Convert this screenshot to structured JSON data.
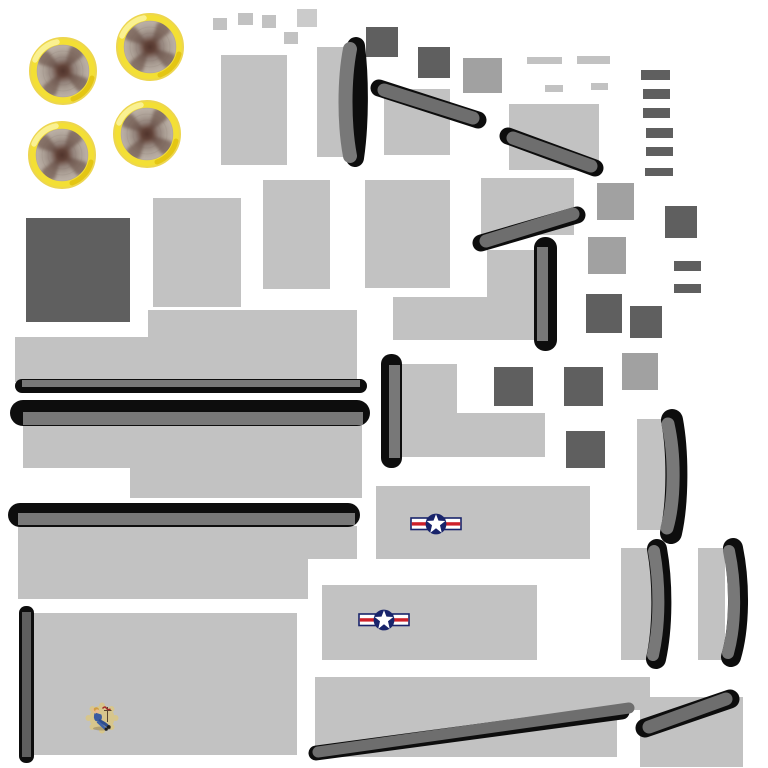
{
  "palette": {
    "bg": "#FFFFFF",
    "light": "#C2C2C2",
    "lighter": "#CBCBCB",
    "medium": "#A1A1A1",
    "dark": "#5F5F5F",
    "strip": "#6E6E6E",
    "bar": "#787878",
    "black": "#0D0D0D",
    "ring_yellow": "#F3DF35",
    "ring_edge": "#EDD64F",
    "roundel_navy": "#19246B",
    "roundel_red": "#CE2029",
    "noseart_tan": "#D7C68C"
  },
  "engines": {
    "radius": 34,
    "placements": [
      {
        "x": 23,
        "y": 31
      },
      {
        "x": 110,
        "y": 7
      },
      {
        "x": 22,
        "y": 115
      },
      {
        "x": 107,
        "y": 94
      }
    ]
  },
  "roundels": [
    {
      "x": 410,
      "y": 513,
      "w": 52,
      "h": 22
    },
    {
      "x": 358,
      "y": 609,
      "w": 52,
      "h": 22
    }
  ],
  "noseart": {
    "x": 84,
    "y": 701,
    "w": 36,
    "h": 34
  },
  "shapes": [
    {
      "k": "r",
      "n": "small-square-1",
      "x": 213,
      "y": 18,
      "w": 14,
      "h": 12,
      "c": "light"
    },
    {
      "k": "r",
      "n": "small-square-2",
      "x": 238,
      "y": 13,
      "w": 15,
      "h": 12,
      "c": "light"
    },
    {
      "k": "r",
      "n": "small-square-3",
      "x": 262,
      "y": 15,
      "w": 14,
      "h": 13,
      "c": "light"
    },
    {
      "k": "r",
      "n": "small-square-4",
      "x": 297,
      "y": 9,
      "w": 20,
      "h": 18,
      "c": "lighter"
    },
    {
      "k": "r",
      "n": "small-square-5",
      "x": 284,
      "y": 32,
      "w": 14,
      "h": 12,
      "c": "light"
    },
    {
      "k": "r",
      "n": "fuselage-panel-1",
      "x": 221,
      "y": 55,
      "w": 66,
      "h": 110,
      "c": "light"
    },
    {
      "k": "r",
      "n": "leading-edge-base-top",
      "x": 317,
      "y": 47,
      "w": 33,
      "h": 110,
      "c": "light"
    },
    {
      "k": "r",
      "n": "dark-square-1",
      "x": 366,
      "y": 27,
      "w": 32,
      "h": 30,
      "c": "dark"
    },
    {
      "k": "r",
      "n": "dark-square-2",
      "x": 418,
      "y": 47,
      "w": 32,
      "h": 31,
      "c": "dark"
    },
    {
      "k": "r",
      "n": "medium-square-1",
      "x": 463,
      "y": 58,
      "w": 39,
      "h": 35,
      "c": "medium"
    },
    {
      "k": "r",
      "n": "fuselage-panel-2",
      "x": 384,
      "y": 89,
      "w": 66,
      "h": 66,
      "c": "light"
    },
    {
      "k": "r",
      "n": "fuselage-panel-3",
      "x": 509,
      "y": 104,
      "w": 90,
      "h": 66,
      "c": "light"
    },
    {
      "k": "r",
      "n": "dash-1",
      "x": 527,
      "y": 57,
      "w": 35,
      "h": 7,
      "c": "light"
    },
    {
      "k": "r",
      "n": "dash-2",
      "x": 577,
      "y": 56,
      "w": 33,
      "h": 8,
      "c": "light"
    },
    {
      "k": "r",
      "n": "dash-3",
      "x": 545,
      "y": 85,
      "w": 18,
      "h": 7,
      "c": "light"
    },
    {
      "k": "r",
      "n": "dash-4",
      "x": 591,
      "y": 83,
      "w": 17,
      "h": 7,
      "c": "light"
    },
    {
      "k": "r",
      "n": "column-bar-1",
      "x": 641,
      "y": 70,
      "w": 29,
      "h": 10,
      "c": "dark"
    },
    {
      "k": "r",
      "n": "column-bar-2",
      "x": 643,
      "y": 89,
      "w": 27,
      "h": 10,
      "c": "dark"
    },
    {
      "k": "r",
      "n": "column-bar-3",
      "x": 643,
      "y": 108,
      "w": 27,
      "h": 10,
      "c": "dark"
    },
    {
      "k": "r",
      "n": "column-bar-4",
      "x": 646,
      "y": 128,
      "w": 27,
      "h": 10,
      "c": "dark"
    },
    {
      "k": "r",
      "n": "column-bar-5",
      "x": 646,
      "y": 147,
      "w": 27,
      "h": 9,
      "c": "dark"
    },
    {
      "k": "r",
      "n": "column-bar-6",
      "x": 645,
      "y": 168,
      "w": 28,
      "h": 8,
      "c": "dark"
    },
    {
      "k": "r",
      "n": "dark-big-square",
      "x": 26,
      "y": 218,
      "w": 104,
      "h": 104,
      "c": "dark"
    },
    {
      "k": "r",
      "n": "fuselage-panel-4",
      "x": 153,
      "y": 198,
      "w": 88,
      "h": 109,
      "c": "light"
    },
    {
      "k": "r",
      "n": "fuselage-panel-5",
      "x": 263,
      "y": 180,
      "w": 67,
      "h": 109,
      "c": "light"
    },
    {
      "k": "r",
      "n": "fuselage-panel-6",
      "x": 365,
      "y": 180,
      "w": 85,
      "h": 108,
      "c": "light"
    },
    {
      "k": "r",
      "n": "fuselage-panel-7",
      "x": 481,
      "y": 178,
      "w": 93,
      "h": 57,
      "c": "light"
    },
    {
      "k": "r",
      "n": "medium-square-2",
      "x": 597,
      "y": 183,
      "w": 37,
      "h": 37,
      "c": "medium"
    },
    {
      "k": "r",
      "n": "dark-square-3",
      "x": 665,
      "y": 206,
      "w": 32,
      "h": 32,
      "c": "dark"
    },
    {
      "k": "r",
      "n": "medium-square-3",
      "x": 588,
      "y": 237,
      "w": 38,
      "h": 37,
      "c": "medium"
    },
    {
      "k": "r",
      "n": "small-bar-1",
      "x": 674,
      "y": 261,
      "w": 27,
      "h": 10,
      "c": "dark"
    },
    {
      "k": "r",
      "n": "small-bar-2",
      "x": 674,
      "y": 284,
      "w": 27,
      "h": 9,
      "c": "dark"
    },
    {
      "k": "r",
      "n": "mid-lshape-top",
      "x": 487,
      "y": 250,
      "w": 48,
      "h": 47,
      "c": "light"
    },
    {
      "k": "r",
      "n": "mid-lshape-bottom",
      "x": 393,
      "y": 297,
      "w": 164,
      "h": 43,
      "c": "light"
    },
    {
      "k": "r",
      "n": "dark-square-4",
      "x": 586,
      "y": 294,
      "w": 36,
      "h": 39,
      "c": "dark"
    },
    {
      "k": "r",
      "n": "dark-square-5",
      "x": 630,
      "y": 306,
      "w": 32,
      "h": 32,
      "c": "dark"
    },
    {
      "k": "r",
      "n": "medium-square-4",
      "x": 622,
      "y": 353,
      "w": 36,
      "h": 37,
      "c": "medium"
    },
    {
      "k": "r",
      "n": "wing1-top",
      "x": 148,
      "y": 310,
      "w": 209,
      "h": 27,
      "c": "light"
    },
    {
      "k": "r",
      "n": "wing1-main",
      "x": 15,
      "y": 337,
      "w": 342,
      "h": 45,
      "c": "light"
    },
    {
      "k": "r",
      "n": "wing2-left",
      "x": 23,
      "y": 425,
      "w": 107,
      "h": 43,
      "c": "light"
    },
    {
      "k": "r",
      "n": "wing2-main",
      "x": 130,
      "y": 425,
      "w": 232,
      "h": 73,
      "c": "light"
    },
    {
      "k": "r",
      "n": "wing3-top",
      "x": 18,
      "y": 526,
      "w": 339,
      "h": 33,
      "c": "light"
    },
    {
      "k": "r",
      "n": "wing3-main",
      "x": 18,
      "y": 559,
      "w": 290,
      "h": 40,
      "c": "light"
    },
    {
      "k": "r",
      "n": "mid-step-top",
      "x": 401,
      "y": 364,
      "w": 56,
      "h": 49,
      "c": "light"
    },
    {
      "k": "r",
      "n": "mid-step-bottom",
      "x": 401,
      "y": 413,
      "w": 144,
      "h": 44,
      "c": "light"
    },
    {
      "k": "r",
      "n": "dark-square-6",
      "x": 494,
      "y": 367,
      "w": 39,
      "h": 39,
      "c": "dark"
    },
    {
      "k": "r",
      "n": "dark-square-7",
      "x": 564,
      "y": 367,
      "w": 39,
      "h": 39,
      "c": "dark"
    },
    {
      "k": "r",
      "n": "dark-square-8",
      "x": 566,
      "y": 431,
      "w": 39,
      "h": 37,
      "c": "dark"
    },
    {
      "k": "r",
      "n": "roundel-panel-1",
      "x": 376,
      "y": 486,
      "w": 214,
      "h": 73,
      "c": "light"
    },
    {
      "k": "r",
      "n": "roundel-panel-2",
      "x": 322,
      "y": 585,
      "w": 215,
      "h": 75,
      "c": "light"
    },
    {
      "k": "r",
      "n": "leading-edge-base-right1",
      "x": 637,
      "y": 419,
      "w": 31,
      "h": 111,
      "c": "light"
    },
    {
      "k": "r",
      "n": "leading-edge-base-right2",
      "x": 621,
      "y": 548,
      "w": 31,
      "h": 112,
      "c": "light"
    },
    {
      "k": "r",
      "n": "leading-edge-base-right3",
      "x": 698,
      "y": 548,
      "w": 27,
      "h": 112,
      "c": "light"
    },
    {
      "k": "r",
      "n": "bottom-left-panel",
      "x": 28,
      "y": 613,
      "w": 269,
      "h": 142,
      "c": "light"
    },
    {
      "k": "r",
      "n": "bottom-center-panel-top",
      "x": 315,
      "y": 677,
      "w": 335,
      "h": 33,
      "c": "light"
    },
    {
      "k": "r",
      "n": "bottom-center-panel",
      "x": 315,
      "y": 677,
      "w": 302,
      "h": 80,
      "c": "light"
    },
    {
      "k": "r",
      "n": "bottom-right-panel",
      "x": 640,
      "y": 697,
      "w": 103,
      "h": 70,
      "c": "light"
    },
    {
      "k": "r",
      "n": "wing1-edge-black",
      "x": 15,
      "y": 379,
      "w": 352,
      "h": 14,
      "rx": 7,
      "c": "black"
    },
    {
      "k": "r",
      "n": "wing1-edge-gray",
      "x": 22,
      "y": 380,
      "w": 338,
      "h": 7,
      "c": "bar"
    },
    {
      "k": "r",
      "n": "wing2-edge-black",
      "x": 10,
      "y": 400,
      "w": 360,
      "h": 26,
      "rx": 13,
      "c": "black"
    },
    {
      "k": "r",
      "n": "wing2-edge-gray",
      "x": 23,
      "y": 412,
      "w": 340,
      "h": 13,
      "c": "bar"
    },
    {
      "k": "r",
      "n": "wing3-edge-black",
      "x": 8,
      "y": 503,
      "w": 352,
      "h": 24,
      "rx": 12,
      "c": "black"
    },
    {
      "k": "r",
      "n": "wing3-edge-gray",
      "x": 18,
      "y": 513,
      "w": 337,
      "h": 12,
      "c": "bar"
    },
    {
      "k": "r",
      "n": "vertical-edge1-black",
      "x": 534,
      "y": 237,
      "w": 23,
      "h": 114,
      "rx": 11,
      "c": "black"
    },
    {
      "k": "r",
      "n": "vertical-edge1-gray",
      "x": 537,
      "y": 247,
      "w": 11,
      "h": 94,
      "c": "bar"
    },
    {
      "k": "r",
      "n": "vertical-edge2-black",
      "x": 381,
      "y": 354,
      "w": 21,
      "h": 114,
      "rx": 10,
      "c": "black"
    },
    {
      "k": "r",
      "n": "vertical-edge2-gray",
      "x": 389,
      "y": 365,
      "w": 11,
      "h": 93,
      "c": "bar"
    },
    {
      "k": "r",
      "n": "left-pole-black",
      "x": 19,
      "y": 606,
      "w": 15,
      "h": 157,
      "rx": 7,
      "c": "black"
    },
    {
      "k": "r",
      "n": "left-pole-gray",
      "x": 22,
      "y": 612,
      "w": 9,
      "h": 145,
      "c": "dark"
    },
    {
      "k": "p",
      "n": "crescent-top-black",
      "d": "M356,46 C360,78 360,124 355,158",
      "w": 18,
      "c": "black"
    },
    {
      "k": "p",
      "n": "crescent-top-gray",
      "d": "M350,49 C344,80 344,124 350,156",
      "w": 14,
      "c": "bar"
    },
    {
      "k": "p",
      "n": "crescent-right1-black",
      "d": "M672,420 C678,452 678,502 671,533",
      "w": 22,
      "c": "black"
    },
    {
      "k": "p",
      "n": "crescent-right1-gray",
      "d": "M668,424 C675,455 675,500 667,528",
      "w": 13,
      "c": "bar"
    },
    {
      "k": "p",
      "n": "crescent-right2-black",
      "d": "M657,549 C663,582 663,627 656,659",
      "w": 20,
      "c": "black"
    },
    {
      "k": "p",
      "n": "crescent-right2-gray",
      "d": "M654,551 C660,584 660,624 653,655",
      "w": 12,
      "c": "bar"
    },
    {
      "k": "p",
      "n": "crescent-right3-black",
      "d": "M733,548 C740,582 740,627 731,657",
      "w": 20,
      "c": "black"
    },
    {
      "k": "p",
      "n": "crescent-right3-gray",
      "d": "M729,551 C736,584 736,624 728,653",
      "w": 12,
      "c": "bar"
    },
    {
      "k": "l",
      "n": "diagonal1-black",
      "x1": 379,
      "y1": 88,
      "x2": 478,
      "y2": 120,
      "w": 17,
      "c": "black"
    },
    {
      "k": "l",
      "n": "diagonal1-gray",
      "x1": 384,
      "y1": 90,
      "x2": 473,
      "y2": 118,
      "w": 13,
      "c": "strip"
    },
    {
      "k": "l",
      "n": "diagonal2-black",
      "x1": 508,
      "y1": 136,
      "x2": 595,
      "y2": 168,
      "w": 17,
      "c": "black"
    },
    {
      "k": "l",
      "n": "diagonal2-gray",
      "x1": 513,
      "y1": 138,
      "x2": 591,
      "y2": 166,
      "w": 13,
      "c": "strip"
    },
    {
      "k": "l",
      "n": "diagonal3-black",
      "x1": 481,
      "y1": 243,
      "x2": 577,
      "y2": 215,
      "w": 17,
      "c": "black"
    },
    {
      "k": "l",
      "n": "diagonal3-gray",
      "x1": 486,
      "y1": 241,
      "x2": 573,
      "y2": 214,
      "w": 13,
      "c": "strip"
    },
    {
      "k": "l",
      "n": "long-diagonal-black",
      "x1": 316,
      "y1": 753,
      "x2": 622,
      "y2": 712,
      "w": 15,
      "c": "black"
    },
    {
      "k": "l",
      "n": "long-diagonal-gray",
      "x1": 318,
      "y1": 752,
      "x2": 629,
      "y2": 708,
      "w": 11,
      "c": "strip"
    },
    {
      "k": "l",
      "n": "short-diagonal-black",
      "x1": 645,
      "y1": 728,
      "x2": 730,
      "y2": 699,
      "w": 19,
      "c": "black"
    },
    {
      "k": "l",
      "n": "short-diagonal-gray",
      "x1": 649,
      "y1": 727,
      "x2": 726,
      "y2": 699,
      "w": 13,
      "c": "strip"
    },
    {
      "k": "u",
      "n": "engine-propeller-texture-1",
      "href": "#sym-engine",
      "x": 23,
      "y": 31,
      "w": 80,
      "h": 80
    },
    {
      "k": "u",
      "n": "engine-propeller-texture-2",
      "href": "#sym-engine",
      "x": 110,
      "y": 7,
      "w": 80,
      "h": 80
    },
    {
      "k": "u",
      "n": "engine-propeller-texture-3",
      "href": "#sym-engine",
      "x": 22,
      "y": 115,
      "w": 80,
      "h": 80
    },
    {
      "k": "u",
      "n": "engine-propeller-texture-4",
      "href": "#sym-engine",
      "x": 107,
      "y": 94,
      "w": 80,
      "h": 80
    },
    {
      "k": "u",
      "n": "usaf-roundel-1",
      "href": "#sym-roundel",
      "x": 410,
      "y": 513,
      "w": 52,
      "h": 22
    },
    {
      "k": "u",
      "n": "usaf-roundel-2",
      "href": "#sym-roundel",
      "x": 358,
      "y": 609,
      "w": 52,
      "h": 22
    },
    {
      "k": "u",
      "n": "nose-art-pinup",
      "href": "#sym-noseart",
      "x": 84,
      "y": 701,
      "w": 36,
      "h": 34
    }
  ]
}
